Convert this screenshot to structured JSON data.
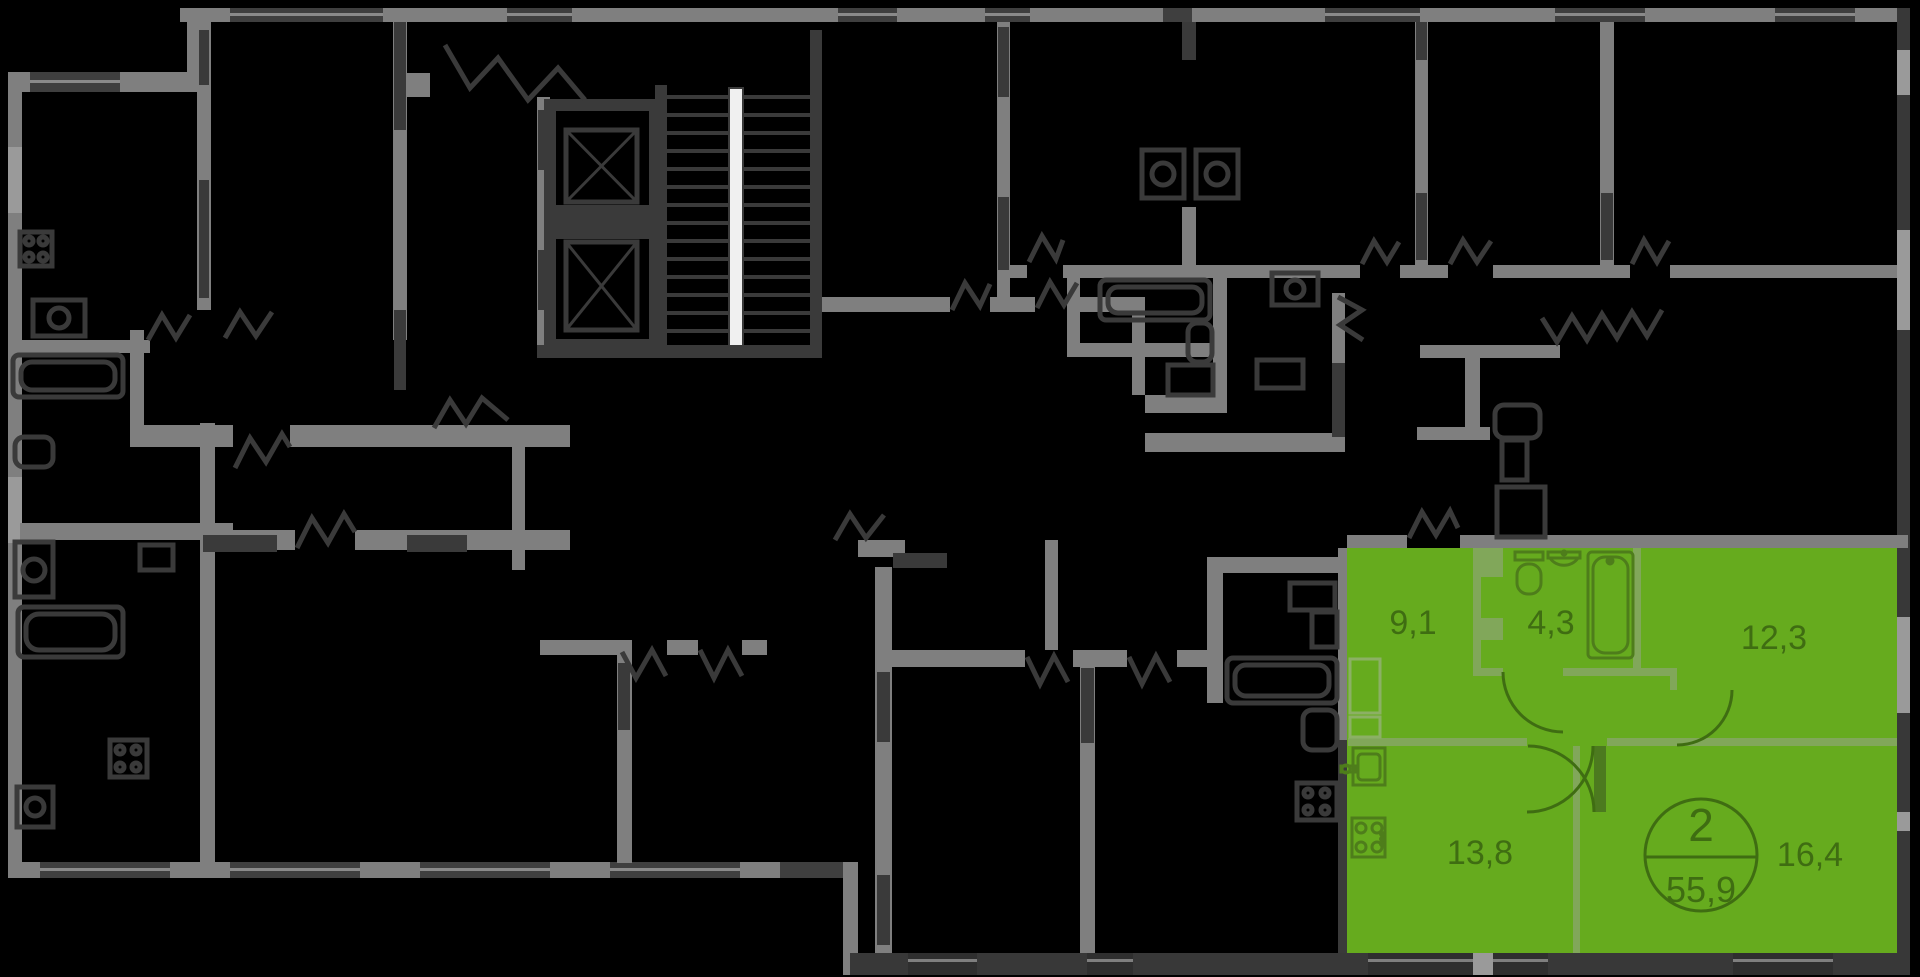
{
  "floor_plan": {
    "highlighted_apartment": {
      "badge": {
        "rooms_count": "2",
        "total_area": "55,9"
      },
      "rooms": [
        {
          "id": "hallway",
          "area_label": "9,1"
        },
        {
          "id": "bathroom",
          "area_label": "4,3"
        },
        {
          "id": "bedroom",
          "area_label": "12,3"
        },
        {
          "id": "kitchen",
          "area_label": "13,8"
        },
        {
          "id": "living-room",
          "area_label": "16,4"
        }
      ],
      "fixture_icons": [
        "toilet-icon",
        "washbasin-icon",
        "bathtub-icon",
        "kitchen-sink-icon",
        "stove-icon"
      ],
      "colors": {
        "highlight_green": "#66AB1E",
        "partition_green": "#81A75A",
        "label_dark_green": "#3F6D12",
        "fixture_line_green": "#4E7D1B",
        "door_leaf_green": "#4C7A1F",
        "niche_line_green": "#8CB065"
      }
    },
    "plan_colors": {
      "background": "#000000",
      "wall_gray": "#7F7F7F",
      "dark_elements": "#3A3A3A",
      "window_light": "#9A9A9A",
      "stair_stringer": "#F0F0F0"
    },
    "other_elements": {
      "elevators": "2",
      "staircase": "1"
    }
  }
}
